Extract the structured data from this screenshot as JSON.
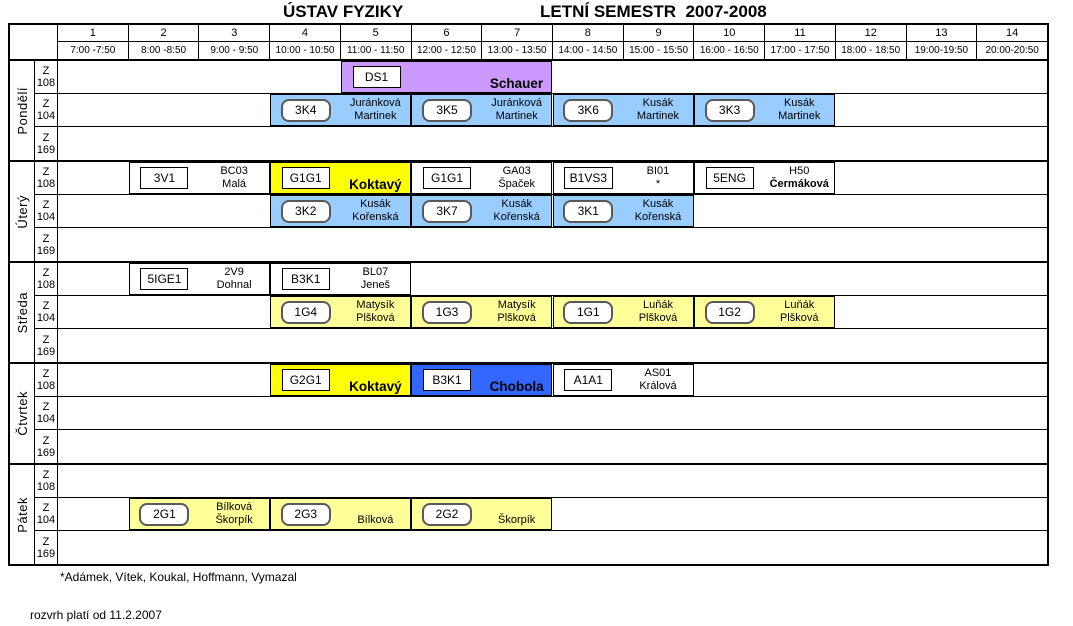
{
  "title": {
    "institute": "ÚSTAV FYZIKY",
    "semester": "LETNÍ SEMESTR  2007-2008"
  },
  "header": {
    "periods": [
      {
        "num": "1",
        "time": "7:00 -7:50"
      },
      {
        "num": "2",
        "time": "8:00 -8:50"
      },
      {
        "num": "3",
        "time": "9:00 - 9:50"
      },
      {
        "num": "4",
        "time": "10:00 - 10:50"
      },
      {
        "num": "5",
        "time": "11:00 - 11:50"
      },
      {
        "num": "6",
        "time": "12:00 - 12:50"
      },
      {
        "num": "7",
        "time": "13:00 - 13:50"
      },
      {
        "num": "8",
        "time": "14:00 - 14:50"
      },
      {
        "num": "9",
        "time": "15:00 - 15:50"
      },
      {
        "num": "10",
        "time": "16:00 - 16:50"
      },
      {
        "num": "11",
        "time": "17:00 - 17:50"
      },
      {
        "num": "12",
        "time": "18:00 - 18:50"
      },
      {
        "num": "13",
        "time": "19:00-19:50"
      },
      {
        "num": "14",
        "time": "20:00-20:50"
      }
    ]
  },
  "room_rows": [
    [
      "Z",
      "108"
    ],
    [
      "Z",
      "104"
    ],
    [
      "Z",
      "169"
    ]
  ],
  "colors": {
    "purple": "#CC99FF",
    "blue": "#99CCFF",
    "yellow": "#FFFF00",
    "royal": "#3366FF",
    "cream": "#FFFF99",
    "white": "#FFFFFF"
  },
  "days": [
    {
      "name": "Pondělí",
      "rows": [
        [
          {
            "code": "DS1",
            "line1": "",
            "line2": "Schauer",
            "emphasis": "bold-large",
            "col": 5,
            "span": 3,
            "bg": "purple",
            "chip": "rect"
          }
        ],
        [
          {
            "code": "3K4",
            "line1": "Juránková",
            "line2": "Martinek",
            "emphasis": null,
            "col": 4,
            "span": 2,
            "bg": "blue",
            "chip": "round"
          },
          {
            "code": "3K5",
            "line1": "Juránková",
            "line2": "Martinek",
            "emphasis": null,
            "col": 6,
            "span": 2,
            "bg": "blue",
            "chip": "round"
          },
          {
            "code": "3K6",
            "line1": "Kusák",
            "line2": "Martinek",
            "emphasis": null,
            "col": 8,
            "span": 2,
            "bg": "blue",
            "chip": "round"
          },
          {
            "code": "3K3",
            "line1": "Kusák",
            "line2": "Martinek",
            "emphasis": null,
            "col": 10,
            "span": 2,
            "bg": "blue",
            "chip": "round"
          }
        ],
        []
      ]
    },
    {
      "name": "Úterý",
      "rows": [
        [
          {
            "code": "3V1",
            "line1": "BC03",
            "line2": "Malá",
            "emphasis": null,
            "col": 2,
            "span": 2,
            "bg": "white",
            "chip": "rect"
          },
          {
            "code": "G1G1",
            "line1": "",
            "line2": "Koktavý",
            "emphasis": "bold-large",
            "col": 4,
            "span": 2,
            "bg": "yellow",
            "chip": "rect"
          },
          {
            "code": "G1G1",
            "line1": "GA03",
            "line2": "Špaček",
            "emphasis": null,
            "col": 6,
            "span": 2,
            "bg": "white",
            "chip": "rect"
          },
          {
            "code": "B1VS3",
            "line1": "BI01",
            "line2": "*",
            "emphasis": null,
            "col": 8,
            "span": 2,
            "bg": "white",
            "chip": "rect"
          },
          {
            "code": "5ENG",
            "line1": "H50",
            "line2": "Čermáková",
            "emphasis": "bold",
            "col": 10,
            "span": 2,
            "bg": "white",
            "chip": "rect"
          }
        ],
        [
          {
            "code": "3K2",
            "line1": "Kusák",
            "line2": "Kořenská",
            "emphasis": null,
            "col": 4,
            "span": 2,
            "bg": "blue",
            "chip": "round"
          },
          {
            "code": "3K7",
            "line1": "Kusák",
            "line2": "Kořenská",
            "emphasis": null,
            "col": 6,
            "span": 2,
            "bg": "blue",
            "chip": "round"
          },
          {
            "code": "3K1",
            "line1": "Kusák",
            "line2": "Kořenská",
            "emphasis": null,
            "col": 8,
            "span": 2,
            "bg": "blue",
            "chip": "round"
          }
        ],
        []
      ]
    },
    {
      "name": "Středa",
      "rows": [
        [
          {
            "code": "5IGE1",
            "line1": "2V9",
            "line2": "Dohnal",
            "emphasis": null,
            "col": 2,
            "span": 2,
            "bg": "white",
            "chip": "rect"
          },
          {
            "code": "B3K1",
            "line1": "BL07",
            "line2": "Jeneš",
            "emphasis": null,
            "col": 4,
            "span": 2,
            "bg": "white",
            "chip": "rect"
          }
        ],
        [
          {
            "code": "1G4",
            "line1": "Matysík",
            "line2": "Plšková",
            "emphasis": null,
            "col": 4,
            "span": 2,
            "bg": "cream",
            "chip": "round"
          },
          {
            "code": "1G3",
            "line1": "Matysík",
            "line2": "Plšková",
            "emphasis": null,
            "col": 6,
            "span": 2,
            "bg": "cream",
            "chip": "round"
          },
          {
            "code": "1G1",
            "line1": "Luňák",
            "line2": "Plšková",
            "emphasis": null,
            "col": 8,
            "span": 2,
            "bg": "cream",
            "chip": "round"
          },
          {
            "code": "1G2",
            "line1": "Luňák",
            "line2": "Plšková",
            "emphasis": null,
            "col": 10,
            "span": 2,
            "bg": "cream",
            "chip": "round"
          }
        ],
        []
      ]
    },
    {
      "name": "Čtvrtek",
      "rows": [
        [
          {
            "code": "G2G1",
            "line1": "",
            "line2": "Koktavý",
            "emphasis": "bold-large",
            "col": 4,
            "span": 2,
            "bg": "yellow",
            "chip": "rect"
          },
          {
            "code": "B3K1",
            "line1": "",
            "line2": "Chobola",
            "emphasis": "bold-large",
            "col": 6,
            "span": 2,
            "bg": "royal",
            "chip": "rect"
          },
          {
            "code": "A1A1",
            "line1": "AS01",
            "line2": "Králová",
            "emphasis": null,
            "col": 8,
            "span": 2,
            "bg": "white",
            "chip": "rect"
          }
        ],
        [],
        []
      ]
    },
    {
      "name": "Pátek",
      "rows": [
        [],
        [
          {
            "code": "2G1",
            "line1": "Bílková",
            "line2": "Škorpík",
            "emphasis": null,
            "col": 2,
            "span": 2,
            "bg": "cream",
            "chip": "round"
          },
          {
            "code": "2G3",
            "line1": "",
            "line2": "Bílková",
            "emphasis": null,
            "col": 4,
            "span": 2,
            "bg": "cream",
            "chip": "round"
          },
          {
            "code": "2G2",
            "line1": "",
            "line2": "Škorpík",
            "emphasis": null,
            "col": 6,
            "span": 2,
            "bg": "cream",
            "chip": "round"
          }
        ],
        []
      ]
    }
  ],
  "footnote": "*Adámek, Vítek, Koukal, Hoffmann, Vymazal",
  "validity": "rozvrh platí od 11.2.2007"
}
